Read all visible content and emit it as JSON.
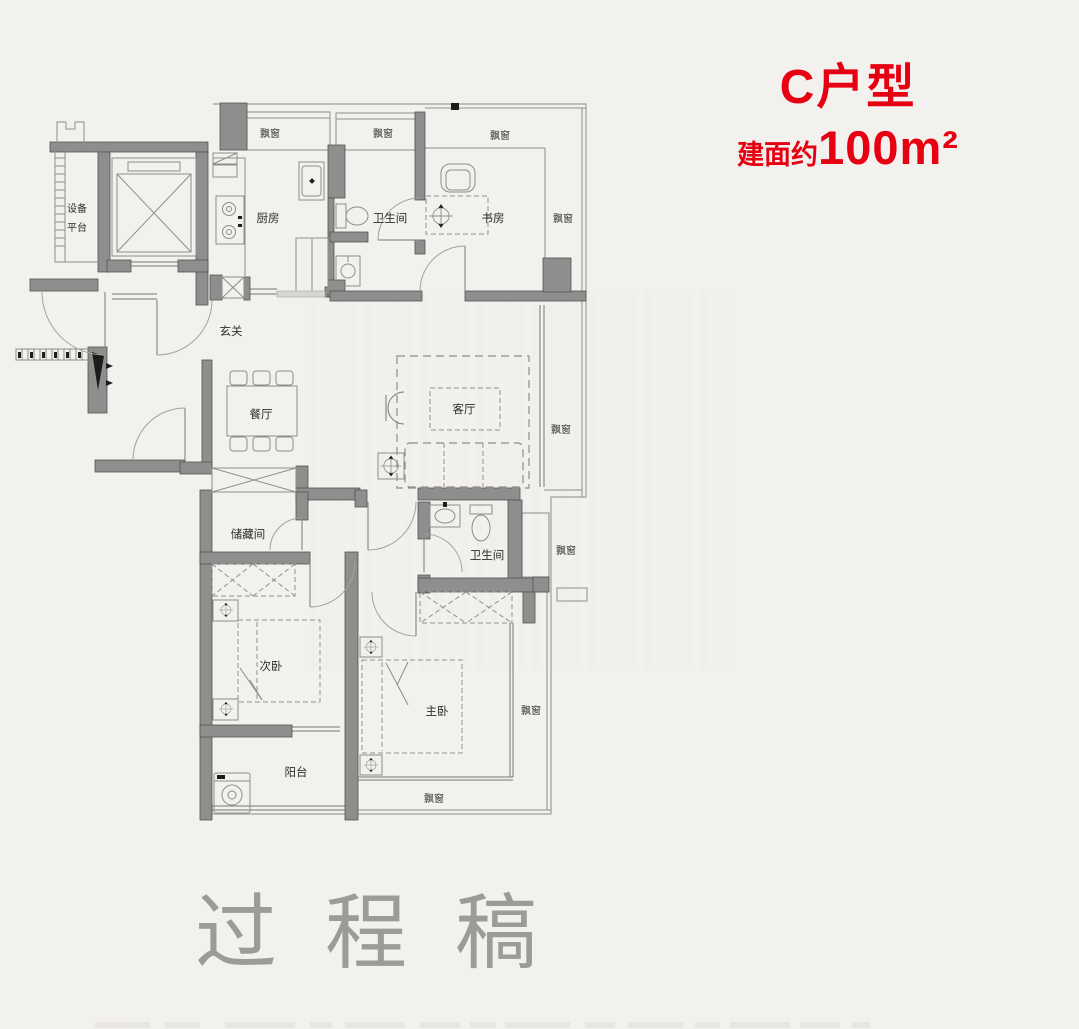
{
  "header": {
    "unit_title": "C户型",
    "area_prefix": "建面约",
    "area_value": "100m²"
  },
  "watermark": "过程稿",
  "labels": {
    "equipment_line1": "设备",
    "equipment_line2": "平台",
    "kitchen": "厨房",
    "bathroom": "卫生间",
    "study": "书房",
    "foyer": "玄关",
    "dining": "餐厅",
    "living": "客厅",
    "storage": "储藏间",
    "bathroom2": "卫生间",
    "bedroom2": "次卧",
    "master_bedroom": "主卧",
    "balcony": "阳台",
    "bay_window": "飘窗"
  },
  "colors": {
    "accent_red": "#e60012",
    "wall_gray": "#8e8e8e",
    "wall_edge": "#55534f",
    "line_gray": "#8f8d89",
    "label_dark": "#2f2d2b",
    "watermark_gray": "#9d9b98",
    "background": "#f2f1ee"
  }
}
